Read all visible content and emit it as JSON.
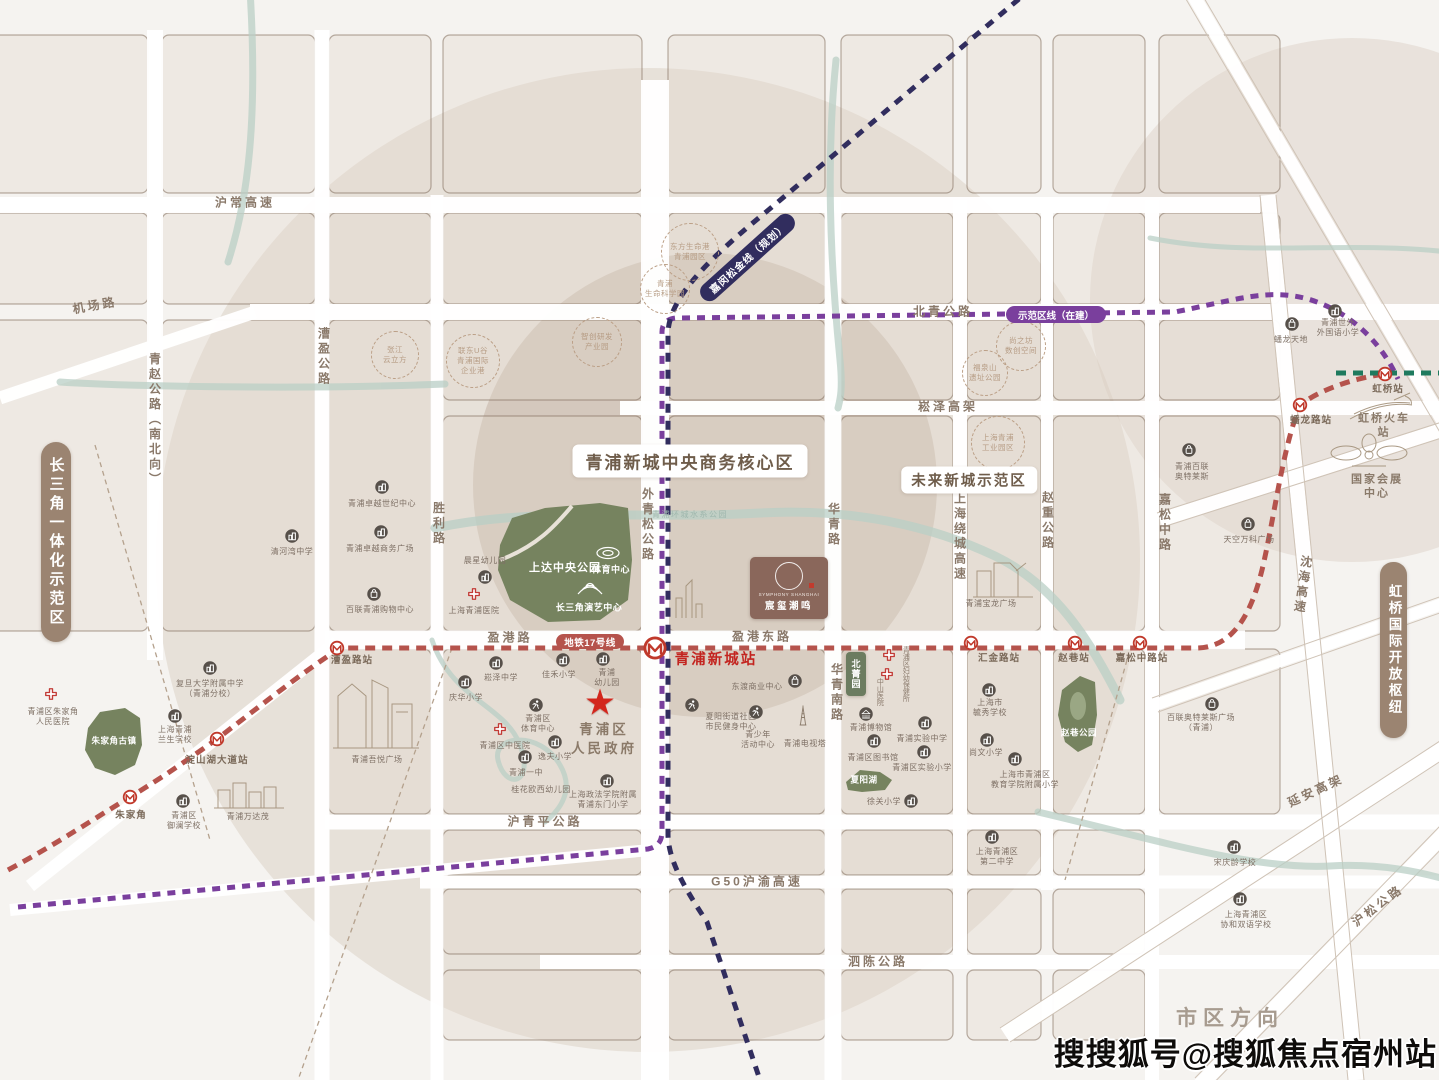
{
  "watermark": "搜搜狐号@搜狐焦点宿州站",
  "project": {
    "name_en": "SYMPHONY SHANGHAI",
    "name_cn": "宸玺潮鸣"
  },
  "zones": {
    "cbd": "青浦新城中央商务核心区",
    "future": "未来新城示范区",
    "left_tag": "长三角一体化示范区",
    "right_tag": "虹桥国际开放枢纽",
    "beijing_park": "北菁园",
    "city_direction": "市区方向"
  },
  "transit": {
    "line17": "地铁17号线",
    "jiamin_line": "嘉闵松金线（规划）",
    "demo_line": "示范区线（在建）"
  },
  "colors": {
    "line17": "#b5534c",
    "jiamin_planned": "#312d5e",
    "demo_line": "#7a3f9d",
    "railway": "#1f7a5e",
    "park": "#76835f",
    "zone_pill": "#9b8471",
    "project_brown": "#8a675b",
    "station_red": "#c3241f"
  },
  "labels": [
    {
      "id": "road-huchang",
      "t": "沪常高速",
      "c": "rh",
      "x": 245,
      "y": 203
    },
    {
      "id": "road-jichang",
      "t": "机场路",
      "c": "rh",
      "x": 95,
      "y": 306,
      "r": -10
    },
    {
      "id": "road-beiqing",
      "t": "北青公路",
      "c": "rh",
      "x": 943,
      "y": 312
    },
    {
      "id": "road-songze",
      "t": "崧泽高架",
      "c": "rh",
      "x": 948,
      "y": 407
    },
    {
      "id": "road-yinggang",
      "t": "盈港路",
      "c": "rh",
      "x": 510,
      "y": 638
    },
    {
      "id": "road-yinggangdong",
      "t": "盈港东路",
      "c": "rh",
      "x": 762,
      "y": 637
    },
    {
      "id": "road-huqingping",
      "t": "沪青平公路",
      "c": "rh",
      "x": 545,
      "y": 822
    },
    {
      "id": "road-g50",
      "t": "G50沪渝高速",
      "c": "rh",
      "x": 757,
      "y": 882
    },
    {
      "id": "road-sichen",
      "t": "泗陈公路",
      "c": "rh",
      "x": 878,
      "y": 962
    },
    {
      "id": "road-yanan",
      "t": "延安高架",
      "c": "rh",
      "x": 1316,
      "y": 791,
      "r": -25
    },
    {
      "id": "road-husong",
      "t": "沪松公路",
      "c": "rh",
      "x": 1378,
      "y": 906,
      "r": -37
    },
    {
      "id": "road-qingzhao",
      "t": "青赵公路（南北向）",
      "c": "rv",
      "x": 154,
      "y": 420
    },
    {
      "id": "road-caoying",
      "t": "漕盈公路",
      "c": "rv",
      "x": 323,
      "y": 357
    },
    {
      "id": "road-shengli",
      "t": "胜利路",
      "c": "rv",
      "x": 438,
      "y": 524
    },
    {
      "id": "road-waiqingsong",
      "t": "外青松公路",
      "c": "rv",
      "x": 647,
      "y": 525
    },
    {
      "id": "road-huaqing",
      "t": "华青路",
      "c": "rv",
      "x": 833,
      "y": 525
    },
    {
      "id": "road-huaqingnan",
      "t": "华青南路",
      "c": "rv",
      "x": 836,
      "y": 693
    },
    {
      "id": "road-raocheng",
      "t": "上海绕城高速",
      "c": "rv",
      "x": 959,
      "y": 537
    },
    {
      "id": "road-zhaozhong",
      "t": "赵重公路",
      "c": "rv",
      "x": 1047,
      "y": 521
    },
    {
      "id": "road-jiasongzhong",
      "t": "嘉松中路",
      "c": "rv",
      "x": 1164,
      "y": 523
    },
    {
      "id": "road-shenhai",
      "t": "沈海高速",
      "c": "rv",
      "x": 1302,
      "y": 585,
      "r": 8
    },
    {
      "id": "city-direction",
      "t": "市区方向",
      "c": "big",
      "x": 1230,
      "y": 1019
    },
    {
      "id": "st-caoyinglu",
      "t": "漕盈路站",
      "c": "st",
      "x": 352,
      "y": 661
    },
    {
      "id": "st-qingpuxincheng",
      "t": "青浦新城站",
      "c": "stm",
      "x": 716,
      "y": 660
    },
    {
      "id": "st-huijinlu",
      "t": "汇金路站",
      "c": "st",
      "x": 999,
      "y": 659
    },
    {
      "id": "st-zhaoxiang",
      "t": "赵巷站",
      "c": "st",
      "x": 1074,
      "y": 659
    },
    {
      "id": "st-jiasongzhonglu",
      "t": "嘉松中路站",
      "c": "st",
      "x": 1142,
      "y": 659
    },
    {
      "id": "st-dianshanhu",
      "t": "淀山湖大道站",
      "c": "st",
      "x": 217,
      "y": 761
    },
    {
      "id": "st-zhujiajiao",
      "t": "朱家角",
      "c": "st",
      "x": 131,
      "y": 816
    },
    {
      "id": "st-panlonglu",
      "t": "蟠龙路站",
      "c": "st",
      "x": 1311,
      "y": 421
    },
    {
      "id": "st-hongqiao",
      "t": "虹桥站",
      "c": "st",
      "x": 1388,
      "y": 390
    },
    {
      "id": "poi-qinghewan",
      "t": "清河湾中学",
      "c": "poi",
      "x": 292,
      "y": 552
    },
    {
      "id": "poi-fudanfz",
      "t": "复旦大学附属中学\n（青浦分校）",
      "c": "poi",
      "x": 210,
      "y": 689
    },
    {
      "id": "poi-lansheng",
      "t": "上海青浦\n兰生学校",
      "c": "poi",
      "x": 175,
      "y": 735
    },
    {
      "id": "poi-zjj-hospital",
      "t": "青浦区朱家角\n人民医院",
      "c": "poi",
      "x": 53,
      "y": 717
    },
    {
      "id": "park-zhujiajiao",
      "t": "朱家角古镇",
      "c": "pkw",
      "x": 114,
      "y": 741
    },
    {
      "id": "poi-wandamao",
      "t": "青浦万达茂",
      "c": "poi",
      "x": 248,
      "y": 817
    },
    {
      "id": "poi-yulan",
      "t": "青浦区\n御澜学校",
      "c": "poi",
      "x": 184,
      "y": 821
    },
    {
      "id": "poi-wuyue",
      "t": "青浦吾悦广场",
      "c": "poi",
      "x": 377,
      "y": 760
    },
    {
      "id": "poi-zhuoyue-century",
      "t": "青浦卓越世纪中心",
      "c": "poi",
      "x": 382,
      "y": 504
    },
    {
      "id": "poi-zhuoyue-biz",
      "t": "青浦卓越商务广场",
      "c": "poi",
      "x": 380,
      "y": 549
    },
    {
      "id": "poi-bailian-qp",
      "t": "百联青浦购物中心",
      "c": "poi",
      "x": 380,
      "y": 610
    },
    {
      "id": "poi-chenxing",
      "t": "晨星幼儿园",
      "c": "poi",
      "x": 485,
      "y": 561
    },
    {
      "id": "poi-qp-hospital",
      "t": "上海青浦医院",
      "c": "poi",
      "x": 474,
      "y": 611
    },
    {
      "id": "poi-songze-school",
      "t": "崧泽中学",
      "c": "poi",
      "x": 501,
      "y": 678
    },
    {
      "id": "poi-qinghua",
      "t": "庆华小学",
      "c": "poi",
      "x": 466,
      "y": 698
    },
    {
      "id": "poi-jiahe",
      "t": "佳禾小学",
      "c": "poi",
      "x": 559,
      "y": 675
    },
    {
      "id": "poi-qp-kid",
      "t": "青浦\n幼儿园",
      "c": "poi",
      "x": 607,
      "y": 678
    },
    {
      "id": "gov",
      "t": "青浦区\n人民政府",
      "c": "gov",
      "x": 604,
      "y": 740
    },
    {
      "id": "poi-qp-sports",
      "t": "青浦区\n体育中心",
      "c": "poi",
      "x": 538,
      "y": 724
    },
    {
      "id": "poi-zhongyi",
      "t": "青浦区中医院",
      "c": "poi",
      "x": 505,
      "y": 746
    },
    {
      "id": "poi-yifu",
      "t": "逸夫小学",
      "c": "poi",
      "x": 555,
      "y": 757
    },
    {
      "id": "poi-yizhong",
      "t": "青浦一中",
      "c": "poi",
      "x": 526,
      "y": 773
    },
    {
      "id": "poi-guihua-kid",
      "t": "桂花欧西幼儿园",
      "c": "poi",
      "x": 541,
      "y": 790
    },
    {
      "id": "poi-zhengfa",
      "t": "上海政法学院附属\n青浦东门小学",
      "c": "poi",
      "x": 603,
      "y": 800
    },
    {
      "id": "poi-dongdu",
      "t": "东渡商业中心",
      "c": "poi",
      "x": 757,
      "y": 687
    },
    {
      "id": "poi-xiayang-fit",
      "t": "夏阳街道社区\n市民健身中心",
      "c": "poi",
      "x": 731,
      "y": 722
    },
    {
      "id": "poi-youth",
      "t": "青少年\n活动中心",
      "c": "poi",
      "x": 758,
      "y": 740
    },
    {
      "id": "poi-tvtower",
      "t": "青浦电视塔",
      "c": "poi",
      "x": 805,
      "y": 744
    },
    {
      "id": "poi-fuyou",
      "t": "青浦区妇幼保健所",
      "c": "pv",
      "x": 905,
      "y": 674
    },
    {
      "id": "poi-zhongshan",
      "t": "中山医院",
      "c": "pv",
      "x": 879,
      "y": 692
    },
    {
      "id": "poi-museum",
      "t": "青浦博物馆",
      "c": "poi",
      "x": 871,
      "y": 728
    },
    {
      "id": "poi-library",
      "t": "青浦区图书馆",
      "c": "poi",
      "x": 873,
      "y": 758
    },
    {
      "id": "park-xiayanghu",
      "t": "夏阳湖",
      "c": "pkw",
      "x": 864,
      "y": 780
    },
    {
      "id": "poi-xuguan",
      "t": "徐关小学",
      "c": "poi",
      "x": 884,
      "y": 802
    },
    {
      "id": "poi-shiyan-middle",
      "t": "青浦实验中学",
      "c": "poi",
      "x": 922,
      "y": 739
    },
    {
      "id": "poi-shiyan-primary",
      "t": "青浦区实验小学",
      "c": "poi",
      "x": 922,
      "y": 768
    },
    {
      "id": "poi-yuxiu",
      "t": "上海市\n毓秀学校",
      "c": "poi",
      "x": 990,
      "y": 708
    },
    {
      "id": "poi-shangwen",
      "t": "尚文小学",
      "c": "poi",
      "x": 986,
      "y": 753
    },
    {
      "id": "poi-edu-primary",
      "t": "上海市青浦区\n教育学院附属小学",
      "c": "poi",
      "x": 1025,
      "y": 780
    },
    {
      "id": "poi-no2",
      "t": "上海青浦区\n第二中学",
      "c": "poi",
      "x": 997,
      "y": 857
    },
    {
      "id": "poi-songqingling",
      "t": "宋庆龄学校",
      "c": "poi",
      "x": 1235,
      "y": 863
    },
    {
      "id": "poi-xiehe",
      "t": "上海青浦区\n协和双语学校",
      "c": "poi",
      "x": 1246,
      "y": 920
    },
    {
      "id": "poi-bailian-outlets",
      "t": "百联奥特莱斯广场\n（青浦）",
      "c": "poi",
      "x": 1201,
      "y": 723
    },
    {
      "id": "poi-baolong",
      "t": "青浦宝龙广场",
      "c": "poi",
      "x": 991,
      "y": 604
    },
    {
      "id": "poi-tiankong",
      "t": "天空万科广场",
      "c": "poi",
      "x": 1249,
      "y": 540
    },
    {
      "id": "poi-qpbl-outlets",
      "t": "青浦百联\n奥特莱斯",
      "c": "poi",
      "x": 1192,
      "y": 472
    },
    {
      "id": "poi-shiwai",
      "t": "青浦世外\n外国语小学",
      "c": "poi",
      "x": 1338,
      "y": 328
    },
    {
      "id": "poi-panlong-tiandi",
      "t": "蟠龙天地",
      "c": "poi",
      "x": 1291,
      "y": 340
    },
    {
      "id": "poi-hongqiao-rail",
      "t": "虹桥火车站",
      "c": "lm",
      "x": 1384,
      "y": 426
    },
    {
      "id": "poi-niecc",
      "t": "国家会展中心",
      "c": "lm",
      "x": 1377,
      "y": 487
    },
    {
      "id": "water-park",
      "t": "青浦环城水系公园",
      "c": "wt",
      "x": 690,
      "y": 515
    },
    {
      "id": "park-shangda",
      "t": "上达中央公园",
      "c": "pk",
      "x": 565,
      "y": 569
    },
    {
      "id": "park-sports-center",
      "t": "体育中心",
      "c": "pk2",
      "x": 611,
      "y": 570
    },
    {
      "id": "park-yanyi",
      "t": "长三角演艺中心",
      "c": "pk2",
      "x": 589,
      "y": 608
    },
    {
      "id": "park-zhaoxiang",
      "t": "赵巷公园",
      "c": "pkw",
      "x": 1079,
      "y": 733
    },
    {
      "id": "project-star",
      "t": "★",
      "c": "star",
      "x": 600,
      "y": 702
    },
    {
      "id": "ind-dongfang",
      "t": "东方生命港\n青浦园区",
      "c": "ind",
      "x": 690,
      "y": 252,
      "w": 56
    },
    {
      "id": "ind-lifesci",
      "t": "青浦\n生命科学园",
      "c": "ind",
      "x": 665,
      "y": 289,
      "w": 48
    },
    {
      "id": "ind-zhangjiang",
      "t": "张江\n云立方",
      "c": "ind",
      "x": 395,
      "y": 355,
      "w": 46
    },
    {
      "id": "ind-liandong",
      "t": "联东U谷\n青浦国际\n企业港",
      "c": "ind",
      "x": 473,
      "y": 361,
      "w": 52
    },
    {
      "id": "ind-zhichuang",
      "t": "智创研发\n产业园",
      "c": "ind",
      "x": 597,
      "y": 342,
      "w": 48
    },
    {
      "id": "ind-shangzhifang",
      "t": "尚之坊\n数创空间",
      "c": "ind",
      "x": 1021,
      "y": 346,
      "w": 48
    },
    {
      "id": "ind-fuquanshan",
      "t": "福泉山\n遗址公园",
      "c": "ind",
      "x": 985,
      "y": 373,
      "w": 44
    },
    {
      "id": "ind-industrial",
      "t": "上海青浦\n工业园区",
      "c": "ind",
      "x": 998,
      "y": 443,
      "w": 52
    }
  ],
  "icons": [
    {
      "k": "m",
      "x": 337,
      "y": 648
    },
    {
      "k": "m",
      "x": 655,
      "y": 648,
      "s": 24
    },
    {
      "k": "m",
      "x": 971,
      "y": 643
    },
    {
      "k": "m",
      "x": 1075,
      "y": 643
    },
    {
      "k": "m",
      "x": 1140,
      "y": 643
    },
    {
      "k": "m",
      "x": 217,
      "y": 739
    },
    {
      "k": "m",
      "x": 130,
      "y": 797
    },
    {
      "k": "m",
      "x": 1300,
      "y": 405
    },
    {
      "k": "m",
      "x": 1385,
      "y": 374
    },
    {
      "k": "x",
      "x": 51,
      "y": 694
    },
    {
      "k": "x",
      "x": 474,
      "y": 594
    },
    {
      "k": "x",
      "x": 500,
      "y": 729
    },
    {
      "k": "x",
      "x": 889,
      "y": 655
    },
    {
      "k": "x",
      "x": 887,
      "y": 674
    },
    {
      "k": "b",
      "x": 292,
      "y": 536
    },
    {
      "k": "b",
      "x": 210,
      "y": 668
    },
    {
      "k": "b",
      "x": 175,
      "y": 716
    },
    {
      "k": "b",
      "x": 183,
      "y": 801
    },
    {
      "k": "b",
      "x": 382,
      "y": 487
    },
    {
      "k": "b",
      "x": 381,
      "y": 532
    },
    {
      "k": "b",
      "x": 485,
      "y": 577
    },
    {
      "k": "b",
      "x": 496,
      "y": 663
    },
    {
      "k": "b",
      "x": 465,
      "y": 682
    },
    {
      "k": "b",
      "x": 563,
      "y": 660
    },
    {
      "k": "b",
      "x": 603,
      "y": 659
    },
    {
      "k": "b",
      "x": 555,
      "y": 742
    },
    {
      "k": "b",
      "x": 525,
      "y": 757
    },
    {
      "k": "b",
      "x": 607,
      "y": 781
    },
    {
      "k": "b",
      "x": 874,
      "y": 741
    },
    {
      "k": "b",
      "x": 911,
      "y": 801
    },
    {
      "k": "b",
      "x": 925,
      "y": 723
    },
    {
      "k": "b",
      "x": 924,
      "y": 752
    },
    {
      "k": "b",
      "x": 989,
      "y": 690
    },
    {
      "k": "b",
      "x": 987,
      "y": 740
    },
    {
      "k": "b",
      "x": 1015,
      "y": 759
    },
    {
      "k": "b",
      "x": 992,
      "y": 837
    },
    {
      "k": "b",
      "x": 1234,
      "y": 847
    },
    {
      "k": "b",
      "x": 1240,
      "y": 899
    },
    {
      "k": "b",
      "x": 1335,
      "y": 311
    },
    {
      "k": "s",
      "x": 374,
      "y": 594
    },
    {
      "k": "s",
      "x": 795,
      "y": 681
    },
    {
      "k": "s",
      "x": 1212,
      "y": 704
    },
    {
      "k": "s",
      "x": 1248,
      "y": 524
    },
    {
      "k": "s",
      "x": 1189,
      "y": 450
    },
    {
      "k": "s",
      "x": 1292,
      "y": 324
    },
    {
      "k": "r",
      "x": 536,
      "y": 705
    },
    {
      "k": "r",
      "x": 692,
      "y": 705
    },
    {
      "k": "r",
      "x": 756,
      "y": 712
    },
    {
      "k": "mu",
      "x": 866,
      "y": 714
    },
    {
      "k": "tw",
      "x": 803,
      "y": 716
    }
  ]
}
